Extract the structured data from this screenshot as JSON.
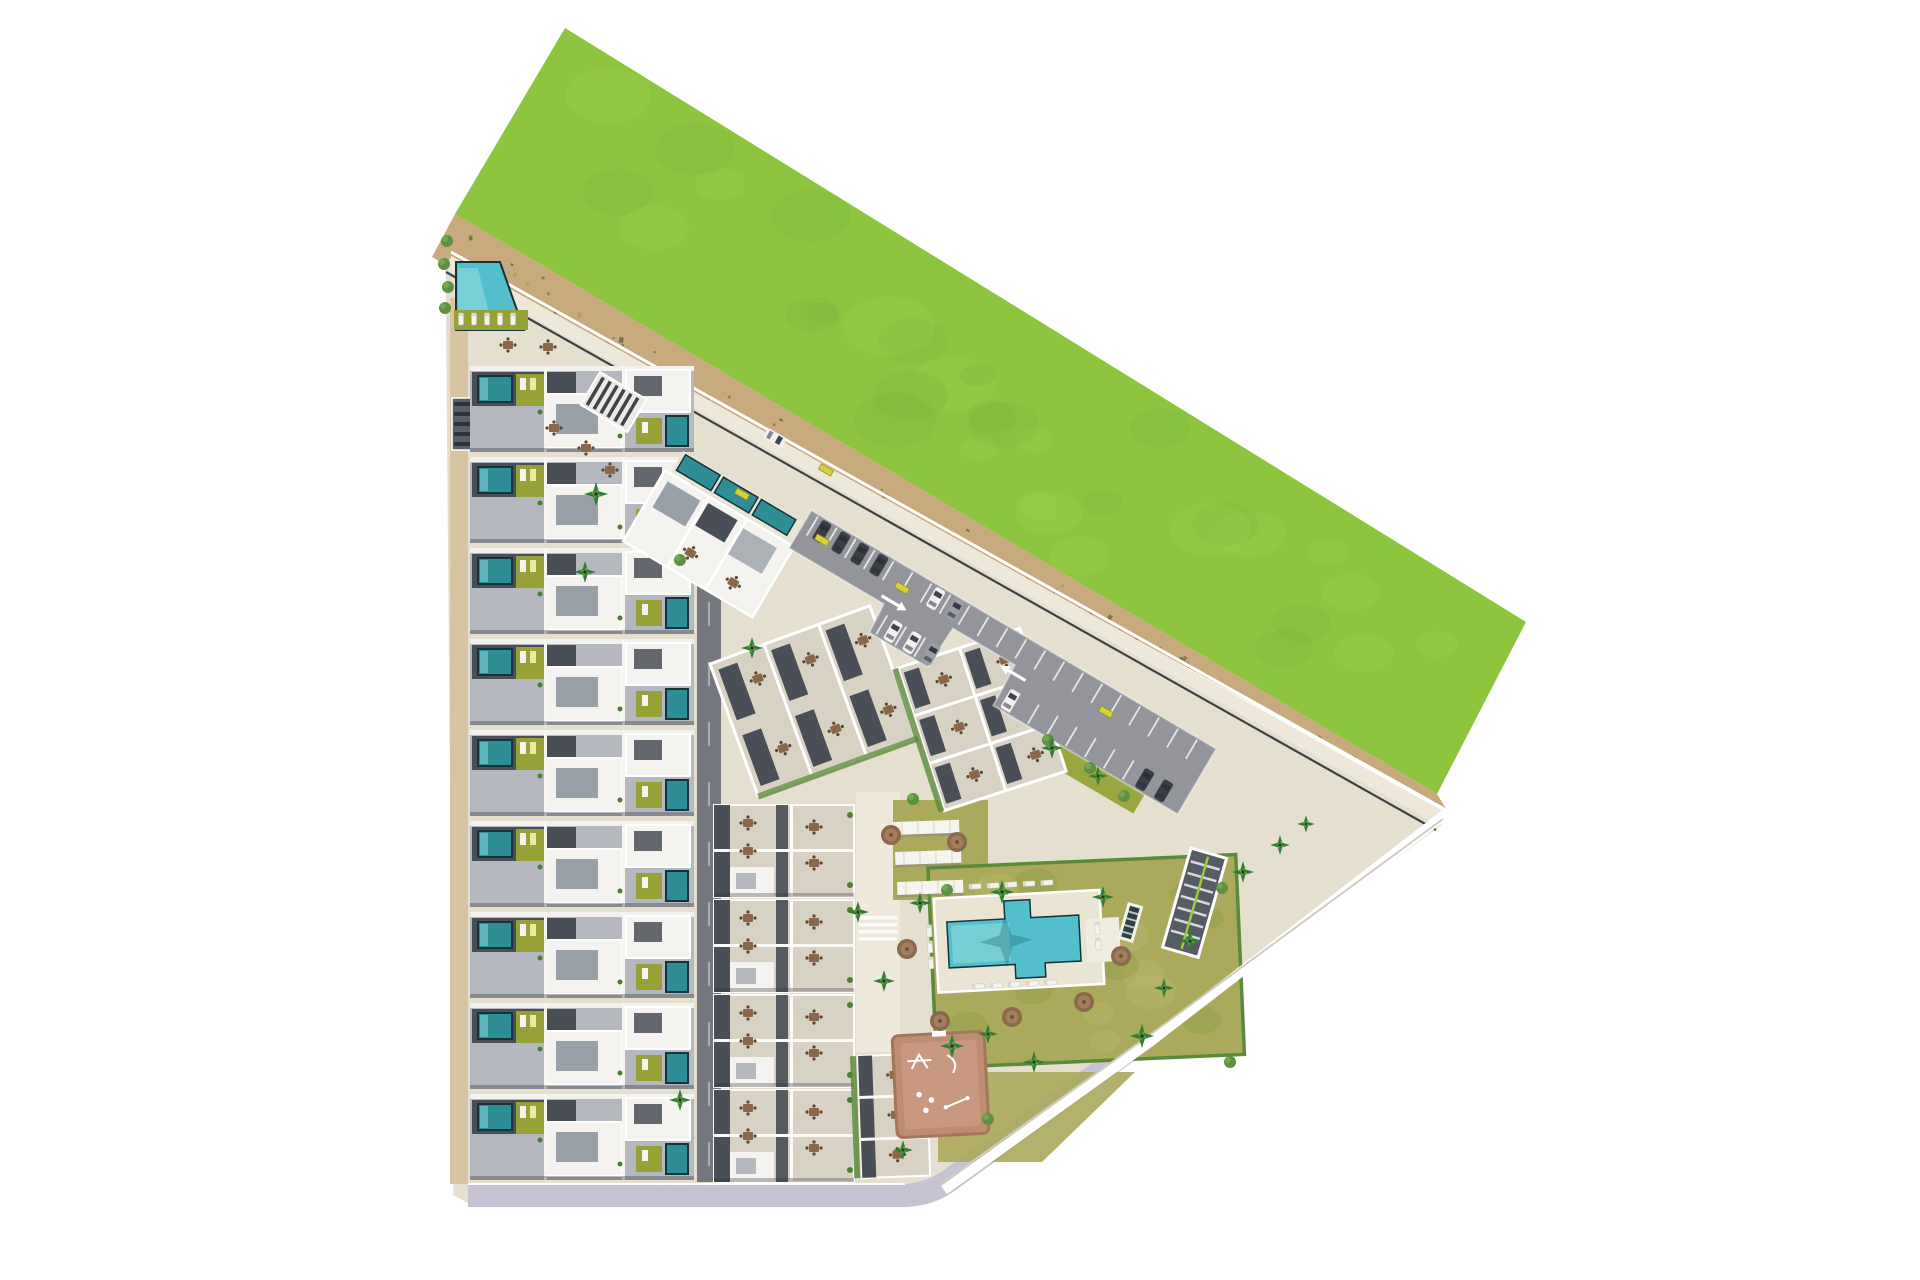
{
  "meta": {
    "description": "Aerial 3D site-plan render of a coastal residential complex: rows of townhouses with private plunge pools, tilted penthouse blocks, surface parking, a communal lagoon pool with palm garden, pergolas, a children's playground and a garage ramp, bordered by a large green meadow and a sandy natural strip.",
    "canvas_width": 1920,
    "canvas_height": 1280,
    "background": "#ffffff"
  },
  "palette": {
    "green_field": "#8ec53f",
    "green_blob_dark": "#7cb23a",
    "green_blob_light": "#9fd14c",
    "sand": "#c9a97e",
    "sand_speckle_dark": "#6f6740",
    "sand_speckle_green": "#5d6b33",
    "sand_speckle_light": "#b2945f",
    "promenade": "#eee8da",
    "edge_line": "#3d4246",
    "boundary_white": "#ffffff",
    "boundary_shadow": "#cfccc2",
    "site_base": "#e5dfd0",
    "path_light": "#efe9dc",
    "alley_dark": "#74777e",
    "road_lavender": "#c8c3d2",
    "walkway_tan": "#d8c4a0",
    "roof_gray": "#b5b8bf",
    "roof_dark": "#4a4f57",
    "roof_white": "#f4f3ef",
    "roof_inset": "#9aa0a8",
    "terrace_light": "#d8d2c5",
    "pool_teal": "#2f8d96",
    "pool_teal_light": "#7fd0d6",
    "pool_rim": "#14333c",
    "main_pool": "#52bfca",
    "main_pool_light": "#9adfe4",
    "lawn_olive": "#96a238",
    "lawn_amenity": "#abaa5c",
    "lawn_blob": "#8f9e45",
    "hedge_green": "#5b8a3a",
    "asphalt": "#93959b",
    "stall_line": "#f5f5f5",
    "car_dark": "#3b3e44",
    "car_white": "#f1f1f1",
    "car_gray": "#9aa0a6",
    "car_glass": "#2c3036",
    "playground_base": "#bd8d71",
    "playground_light": "#cfa287",
    "playground_line": "#ffffff",
    "ramp_dark": "#575b63",
    "ramp_stripe": "#d9d9d9",
    "ramp_green": "#9acb3c",
    "accent_yellow": "#d6d23e",
    "palm_dark": "#2e7d36",
    "palm_light": "#55a341",
    "shrub_green": "#5d9141",
    "umbrella_brown": "#8a6a4d",
    "umbrella_light": "#a5805e",
    "furniture_brown": "#8a6748",
    "pergola_white": "#f6f4ee"
  },
  "legend": {
    "areas": [
      {
        "name": "green-meadow",
        "label": "Undeveloped green meadow to the north-east"
      },
      {
        "name": "beach-sand-strip",
        "label": "Sandy natural strip with scrub vegetation along the boundary"
      },
      {
        "name": "coastal-promenade",
        "label": "Perimeter promenade road with dark guide line"
      },
      {
        "name": "townhouse-column-west",
        "label": "Nine rows of terraced townhouses with private plunge pools and gardens"
      },
      {
        "name": "townhouse-column-inner",
        "label": "Inner rows of townhouses with rooftop terraces"
      },
      {
        "name": "corner-townhouse-block",
        "label": "Corner townhouse block at the south"
      },
      {
        "name": "tilted-villa-block",
        "label": "Tilted penthouse block with three pools facing the promenade"
      },
      {
        "name": "apartment-block-a",
        "label": "Central apartment block with roof terraces"
      },
      {
        "name": "apartment-block-b",
        "label": "Eastern apartment block with roof terraces"
      },
      {
        "name": "parking-lot",
        "label": "Surface parking with marked stalls and vehicles"
      },
      {
        "name": "corner-pool",
        "label": "Secondary communal pool at the north-west corner"
      },
      {
        "name": "main-pool",
        "label": "Communal lagoon pool with sun deck and loungers"
      },
      {
        "name": "pool-lawn",
        "label": "Hedged palm garden around the main pool"
      },
      {
        "name": "pergola-shades",
        "label": "Three shaded pergola seating areas on the lawn"
      },
      {
        "name": "playground",
        "label": "Children's playground with white play equipment"
      },
      {
        "name": "garage-ramp",
        "label": "Striped ramp to the underground garage"
      },
      {
        "name": "bottom-road",
        "label": "Access road along the southern boundary"
      }
    ]
  },
  "counts": {
    "townhouse_rows_west": 9,
    "townhouse_rows_inner": 4,
    "corner_townhouse_blocks": 1,
    "penthouse_blocks": 3,
    "pergola_shades": 3,
    "parked_cars": 13,
    "communal_pools": 2,
    "private_plunge_pools": 21,
    "palm_trees": 21,
    "parasol_trees": 7,
    "garden_shrubs": 13,
    "sun_loungers": 21,
    "yellow_benches": 5,
    "playgrounds": 1,
    "garage_ramps": 1
  },
  "layout": {
    "green_field_points": "565,28 1526,622 1437,794 455,214",
    "sand_points": "455,214 1437,794 1448,812 1418,840 432,257",
    "site_points": "444,262 1448,812 1440,828 1150,1042 940,1192 903,1204 470,1206 452,1196",
    "rows_west": {
      "def": "rowA",
      "name": "townhouse-row",
      "x": 470,
      "y0": 366,
      "pitch": 91,
      "count": 9
    },
    "rows_inner": {
      "def": "rowB",
      "name": "townhouse-row-inner",
      "x": 714,
      "y0": 805,
      "pitch": 95,
      "count": 4
    },
    "parking": {
      "margin": 8,
      "pitch": 22,
      "count": 20
    },
    "sand_speckles": {
      "count": 120,
      "seed": 4,
      "x0": 444,
      "y0": 235,
      "x1": 1428,
      "y1": 817,
      "spread": 16,
      "colors": [
        "sand_speckle_dark",
        "sand_speckle_green",
        "sand_speckle_light"
      ]
    },
    "green_blobs": {
      "count": 32,
      "seed": 11,
      "quad": [
        [
          565,
          28
        ],
        [
          1526,
          622
        ],
        [
          455,
          214
        ],
        [
          1437,
          794
        ]
      ],
      "colors": [
        "green_blob_dark",
        "green_blob_light"
      ]
    },
    "lawn_blobs": {
      "count": 18,
      "seed": 9,
      "w": 308,
      "h": 200,
      "colors": [
        "lawn_blob",
        "#b9b66e"
      ]
    },
    "uses": {
      "palms": {
        "def": "palm",
        "name": "palm-tree",
        "items": [
          [
            596,
            494,
            0,
            1.1
          ],
          [
            585,
            572
          ],
          [
            752,
            648
          ],
          [
            680,
            1100
          ],
          [
            858,
            912
          ],
          [
            920,
            903
          ],
          [
            1002,
            892,
            0,
            1.1
          ],
          [
            1103,
            897
          ],
          [
            952,
            1046,
            0,
            1.1
          ],
          [
            1034,
            1062
          ],
          [
            1142,
            1036,
            0,
            1.1
          ],
          [
            884,
            981
          ],
          [
            1190,
            941
          ],
          [
            1243,
            872
          ],
          [
            1280,
            845,
            0,
            0.9
          ],
          [
            1306,
            824,
            0,
            0.8
          ],
          [
            1052,
            748
          ],
          [
            1098,
            776,
            0,
            0.9
          ],
          [
            988,
            1034,
            0,
            0.9
          ],
          [
            903,
            1150,
            0,
            0.9
          ],
          [
            1164,
            988,
            0,
            0.9
          ]
        ]
      },
      "umbrellas": {
        "def": "umbrella",
        "name": "parasol-tree",
        "items": [
          [
            940,
            1021
          ],
          [
            1012,
            1017
          ],
          [
            1084,
            1002
          ],
          [
            1121,
            956
          ],
          [
            907,
            949
          ],
          [
            957,
            842
          ],
          [
            891,
            835
          ]
        ]
      },
      "shrubs": {
        "def": "shrub",
        "name": "garden-shrub",
        "items": [
          [
            447,
            241
          ],
          [
            444,
            264
          ],
          [
            448,
            287
          ],
          [
            445,
            308
          ],
          [
            913,
            799
          ],
          [
            1048,
            740
          ],
          [
            1090,
            768
          ],
          [
            1124,
            796
          ],
          [
            947,
            890
          ],
          [
            1222,
            888
          ],
          [
            1230,
            1062
          ],
          [
            988,
            1119
          ],
          [
            680,
            560
          ]
        ]
      },
      "benches": {
        "def": "bench",
        "name": "yellow-bench",
        "items": [
          [
            742,
            494,
            30
          ],
          [
            822,
            540,
            30
          ],
          [
            902,
            588,
            30
          ],
          [
            1106,
            712,
            30
          ],
          [
            826,
            470,
            30
          ]
        ]
      },
      "corner_loungers": {
        "def": "lounger",
        "name": "sun-lounger",
        "items": [
          [
            461,
            319,
            90
          ],
          [
            474,
            319,
            90
          ],
          [
            487,
            319,
            90
          ],
          [
            500,
            319,
            90
          ],
          [
            513,
            319,
            90
          ]
        ]
      },
      "pool_loungers": {
        "def": "lounger",
        "name": "sun-lounger",
        "items": [
          [
            12,
            -18
          ],
          [
            30,
            -18
          ],
          [
            48,
            -18
          ],
          [
            66,
            -18
          ],
          [
            84,
            -18
          ],
          [
            102,
            -18
          ],
          [
            28,
            82
          ],
          [
            46,
            82
          ],
          [
            64,
            82
          ],
          [
            82,
            82
          ],
          [
            100,
            82
          ],
          [
            -18,
            24,
            90
          ],
          [
            -18,
            40,
            90
          ],
          [
            -18,
            56,
            90
          ],
          [
            150,
            30,
            90
          ],
          [
            150,
            46,
            90
          ]
        ]
      },
      "lot_cars": {
        "def": "car",
        "name": "parked-car",
        "items": [
          [
            20,
            -25,
            0,
            1,
            "car_dark"
          ],
          [
            42,
            -25,
            0,
            1,
            "car_dark"
          ],
          [
            64,
            -25,
            0,
            1,
            "car_dark"
          ],
          [
            86,
            -25,
            0,
            1,
            "car_dark"
          ],
          [
            152,
            -25,
            0,
            1,
            "car_white"
          ],
          [
            174,
            -25,
            0,
            1,
            "car_gray"
          ],
          [
            132,
            25,
            0,
            1,
            "car_white"
          ],
          [
            154,
            25,
            0,
            1,
            "car_white"
          ],
          [
            176,
            25,
            0,
            1,
            "car_gray"
          ],
          [
            268,
            25,
            0,
            1,
            "car_white"
          ],
          [
            424,
            25,
            0,
            1,
            "car_dark"
          ],
          [
            446,
            25,
            0,
            1,
            "car_dark"
          ]
        ]
      },
      "free_cars": {
        "def": "car",
        "name": "parked-car",
        "items": [
          [
            775,
            438,
            120,
            1,
            "car_white"
          ]
        ]
      },
      "plaza_tables": {
        "def": "furn",
        "name": "outdoor-table-set",
        "items": [
          [
            508,
            345
          ],
          [
            548,
            347
          ],
          [
            554,
            428
          ],
          [
            586,
            448
          ],
          [
            610,
            470
          ]
        ]
      }
    }
  }
}
